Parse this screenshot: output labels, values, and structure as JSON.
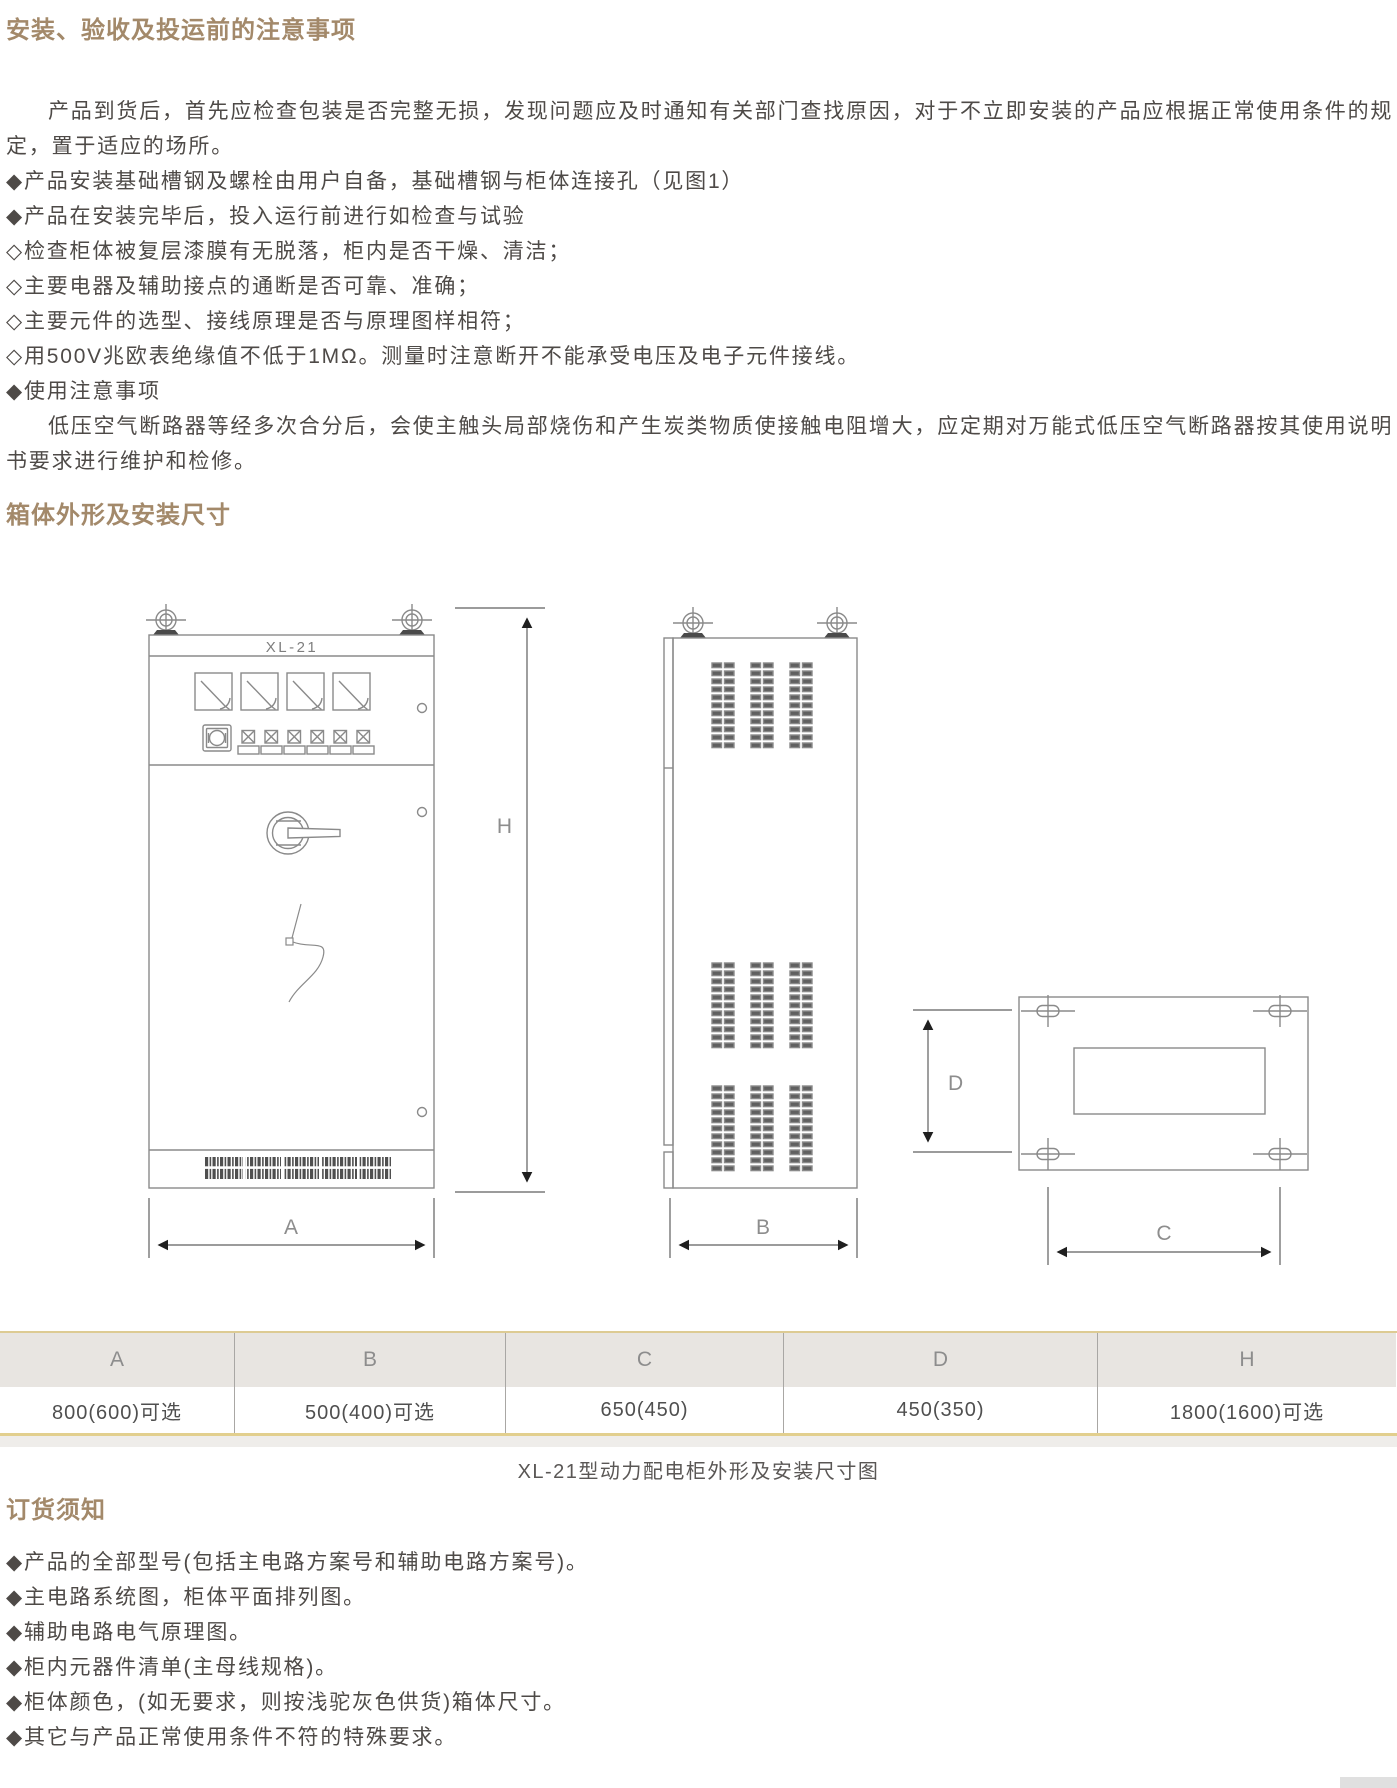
{
  "page": {
    "accent_color": "#a3896a",
    "text_color": "#4e4a47",
    "drawing_line_color": "#8a8a8a",
    "table_gold_color": "#e2cf8e"
  },
  "section_install": {
    "heading": "安装、验收及投运前的注意事项",
    "paragraphs": [
      {
        "text": "产品到货后，首先应检查包装是否完整无损，发现问题应及时通知有关部门查找原因，对于不立即安装的产品应根据正常使用条件的规定，置于适应的场所。"
      },
      {
        "text": "◆产品安装基础槽钢及螺栓由用户自备，基础槽钢与柜体连接孔（见图1）"
      },
      {
        "text": "◆产品在安装完毕后，投入运行前进行如检查与试验"
      },
      {
        "text": "◇检查柜体被复层漆膜有无脱落，柜内是否干燥、清洁；"
      },
      {
        "text": "◇主要电器及辅助接点的通断是否可靠、准确；"
      },
      {
        "text": "◇主要元件的选型、接线原理是否与原理图样相符；"
      },
      {
        "text": "◇用500V兆欧表绝缘值不低于1MΩ。测量时注意断开不能承受电压及电子元件接线。"
      },
      {
        "text": "◆使用注意事项"
      },
      {
        "text": "低压空气断路器等经多次合分后，会使主触头局部烧伤和产生炭类物质使接触电阻增大，应定期对万能式低压空气断路器按其使用说明书要求进行维护和检修。"
      }
    ]
  },
  "section_dimensions": {
    "heading": "箱体外形及安装尺寸",
    "diagram": {
      "cabinet_model": "XL-21",
      "dim_labels": {
        "width": "A",
        "depth": "B",
        "hole_span_width": "C",
        "hole_span_depth": "D",
        "height": "H"
      }
    },
    "table": {
      "columns": [
        "A",
        "B",
        "C",
        "D",
        "H"
      ],
      "values": [
        "800(600)可选",
        "500(400)可选",
        "650(450)",
        "450(350)",
        "1800(1600)可选"
      ]
    },
    "caption": "XL-21型动力配电柜外形及安装尺寸图"
  },
  "section_order": {
    "heading": "订货须知",
    "items": [
      {
        "text": "◆产品的全部型号(包括主电路方案号和辅助电路方案号)。"
      },
      {
        "text": "◆主电路系统图，柜体平面排列图。"
      },
      {
        "text": "◆辅助电路电气原理图。"
      },
      {
        "text": "◆柜内元器件清单(主母线规格)。"
      },
      {
        "text": "◆柜体颜色，(如无要求，则按浅驼灰色供货)箱体尺寸。"
      },
      {
        "text": "◆其它与产品正常使用条件不符的特殊要求。"
      }
    ]
  }
}
